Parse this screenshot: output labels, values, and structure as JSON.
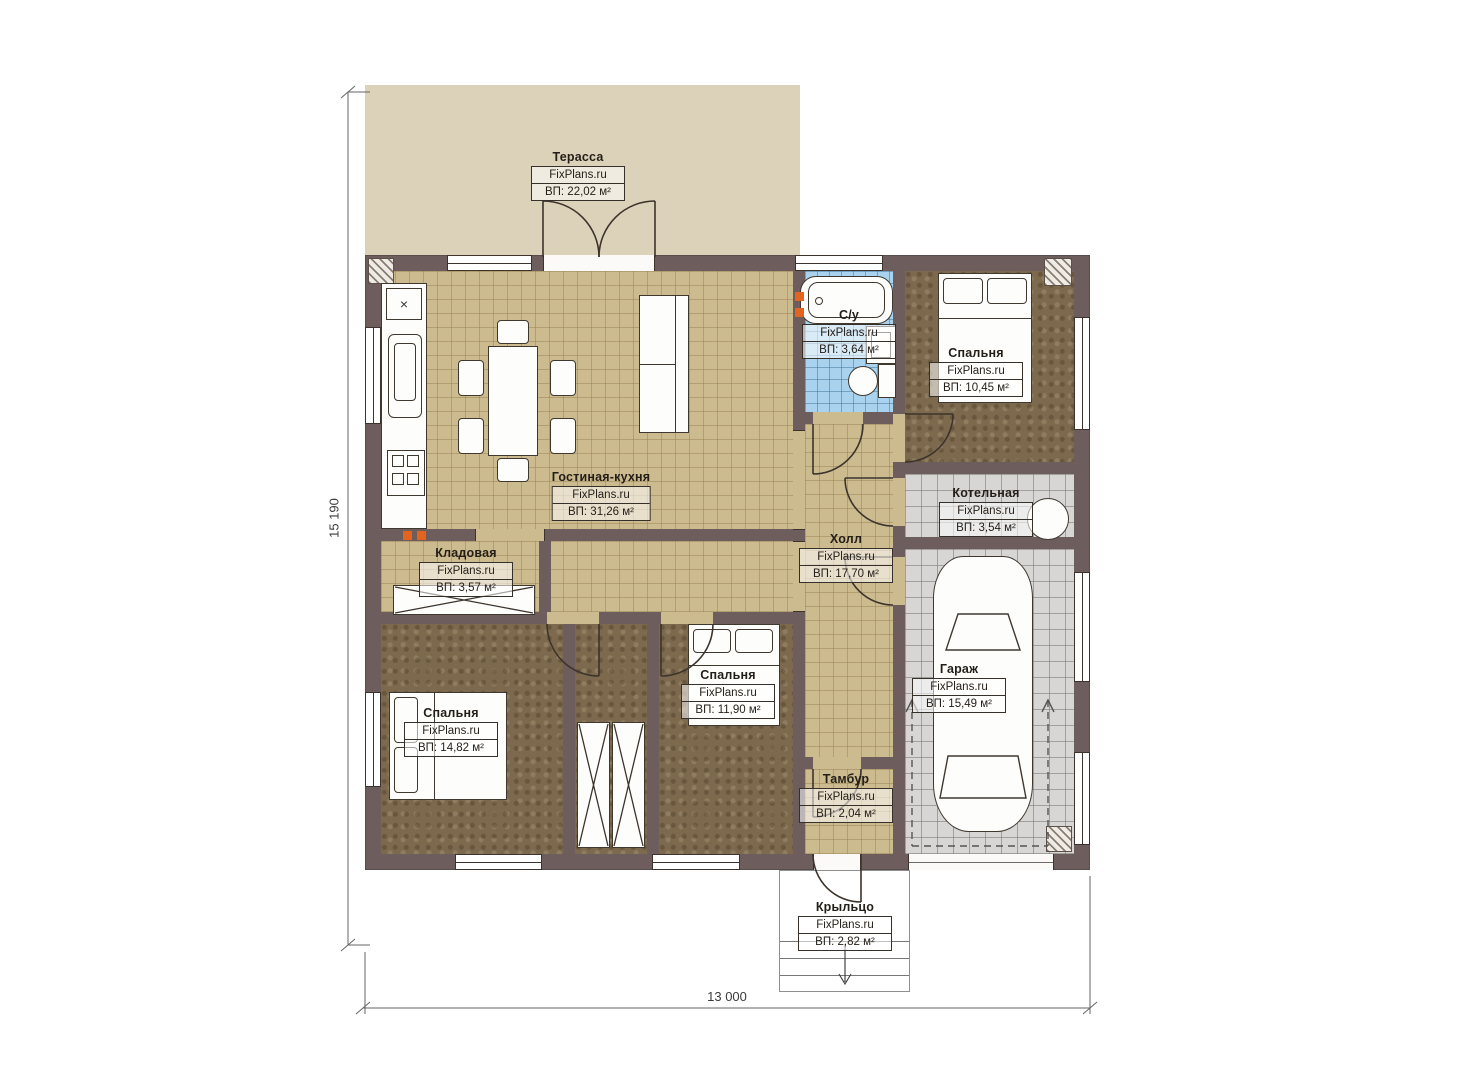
{
  "site_watermark": "FixPlans.ru",
  "dimensions": {
    "total_depth": "15 190",
    "total_width": "13 000"
  },
  "icons": {
    "sink_cross": "×"
  },
  "colors": {
    "wall": "#6e5d5d",
    "tile_beige": "#cdbb90",
    "tile_blue": "#a9d2ee",
    "tile_grey": "#d7d6d4",
    "floor_brown": "#7d6a4e",
    "terrace": "#dcd2ba",
    "radiator": "#e4641e"
  },
  "rooms": [
    {
      "id": "terrace",
      "name": "Терасса",
      "area": "ВП: 22,02 м²"
    },
    {
      "id": "living-kitchen",
      "name": "Гостиная-кухня",
      "area": "ВП: 31,26 м²"
    },
    {
      "id": "bathroom",
      "name": "С/у",
      "area": "ВП: 3,64 м²"
    },
    {
      "id": "bedroom-top-right",
      "name": "Спальня",
      "area": "ВП: 10,45 м²"
    },
    {
      "id": "boiler-room",
      "name": "Котельная",
      "area": "ВП: 3,54 м²"
    },
    {
      "id": "hall",
      "name": "Холл",
      "area": "ВП: 17,70 м²"
    },
    {
      "id": "storage",
      "name": "Кладовая",
      "area": "ВП: 3,57 м²"
    },
    {
      "id": "bedroom-bottom-left",
      "name": "Спальня",
      "area": "ВП: 14,82 м²"
    },
    {
      "id": "bedroom-bottom-middle",
      "name": "Спальня",
      "area": "ВП: 11,90 м²"
    },
    {
      "id": "garage",
      "name": "Гараж",
      "area": "ВП: 15,49 м²"
    },
    {
      "id": "tambour",
      "name": "Тамбур",
      "area": "ВП: 2,04 м²"
    },
    {
      "id": "porch",
      "name": "Крыльцо",
      "area": "ВП: 2,82 м²"
    }
  ]
}
